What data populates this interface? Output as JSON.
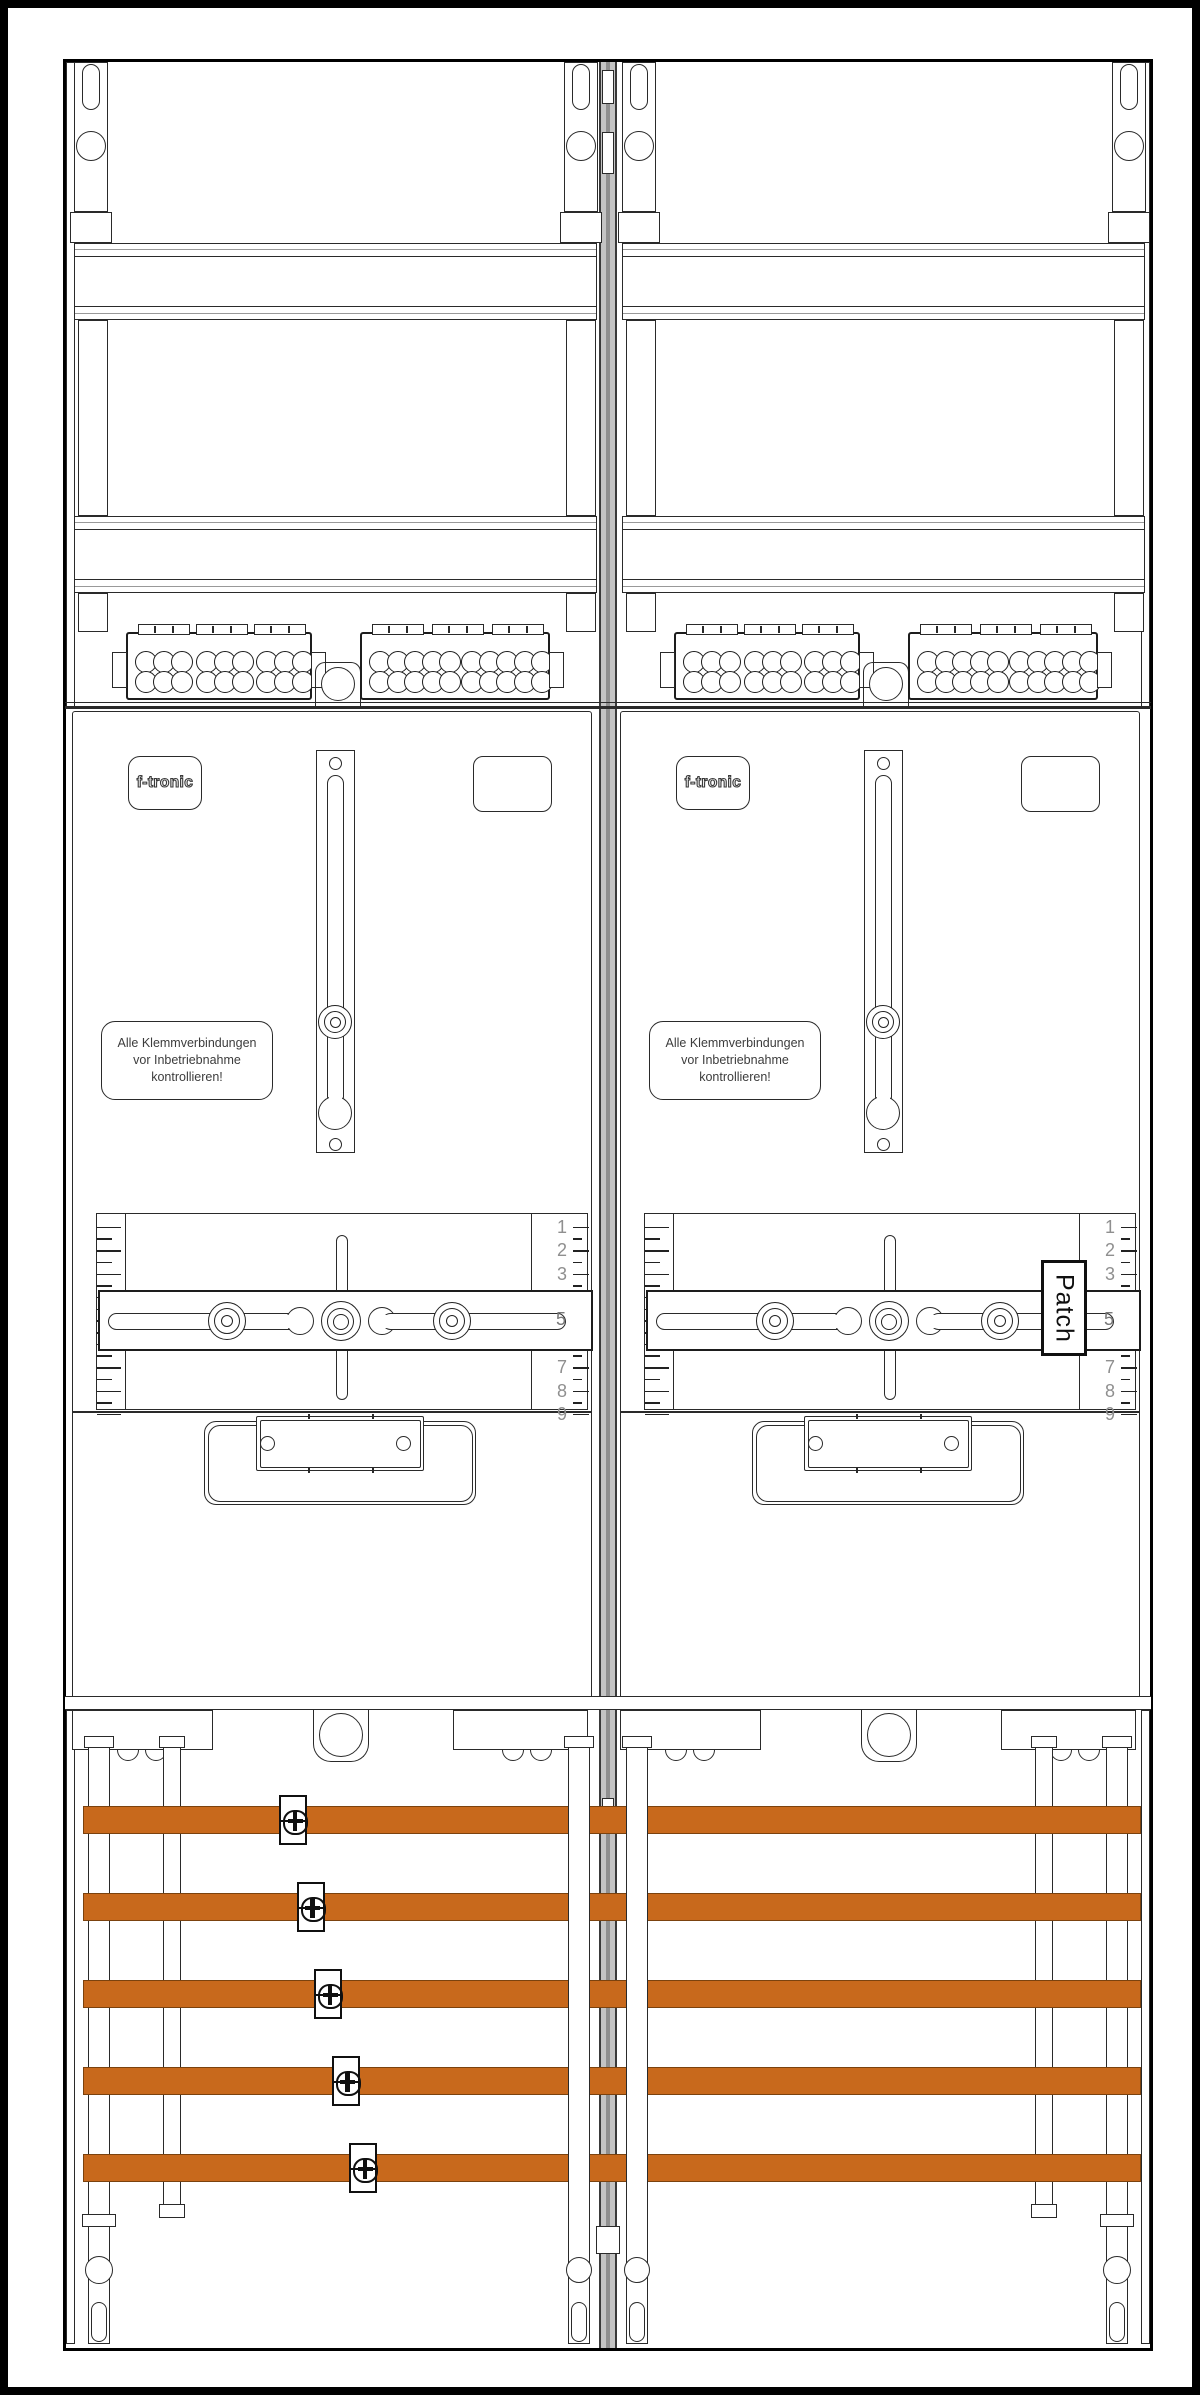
{
  "cabinet": {
    "brand_label": "f-tronic",
    "warning": {
      "line1": "Alle Klemmverbindungen",
      "line2": "vor Inbetriebnahme",
      "line3": "kontrollieren!"
    },
    "patch_label": "Patch",
    "ruler": {
      "numbers": [
        "1",
        "2",
        "3",
        "4",
        "5",
        "6",
        "7",
        "8",
        "9"
      ],
      "slider_value": "5"
    },
    "busbars": {
      "count": 5,
      "color": "#C8691C",
      "clamp_count": 5
    },
    "terminals": {
      "rows": 2,
      "blocks": [
        {
          "groups": 3,
          "cols_per_group": 3
        },
        {
          "groups": 2,
          "cols_per_group": 5
        }
      ],
      "knockouts_per_panel": 1
    },
    "panels": {
      "count": 2
    }
  }
}
